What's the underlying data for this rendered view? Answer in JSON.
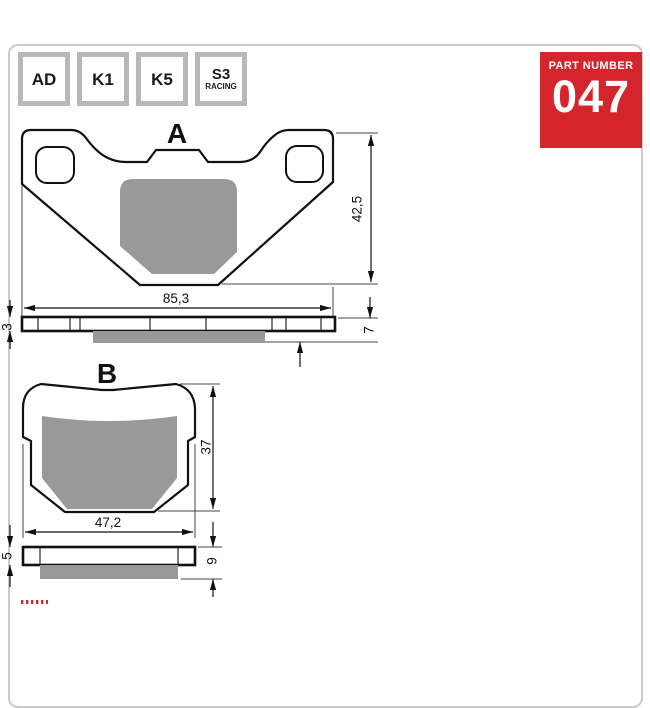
{
  "header": {
    "compounds": [
      {
        "code": "AD"
      },
      {
        "code": "K1"
      },
      {
        "code": "K5"
      },
      {
        "code": "S3",
        "sub": "RACING"
      }
    ],
    "part_number": {
      "label": "PART NUMBER",
      "value": "047"
    }
  },
  "colors": {
    "accent_red": "#d5252c",
    "pad_gray": "#999999",
    "box_border_gray": "#b8b8b8",
    "frame_border": "#cbcbcb",
    "line": "#111111"
  },
  "diagram": {
    "view_a": {
      "title": "A",
      "width": "85,3",
      "height": "42,5",
      "plate_thickness": "3",
      "total_thickness": "7"
    },
    "view_b": {
      "title": "B",
      "width": "47,2",
      "height": "37",
      "plate_thickness": "5",
      "total_thickness": "9"
    }
  }
}
